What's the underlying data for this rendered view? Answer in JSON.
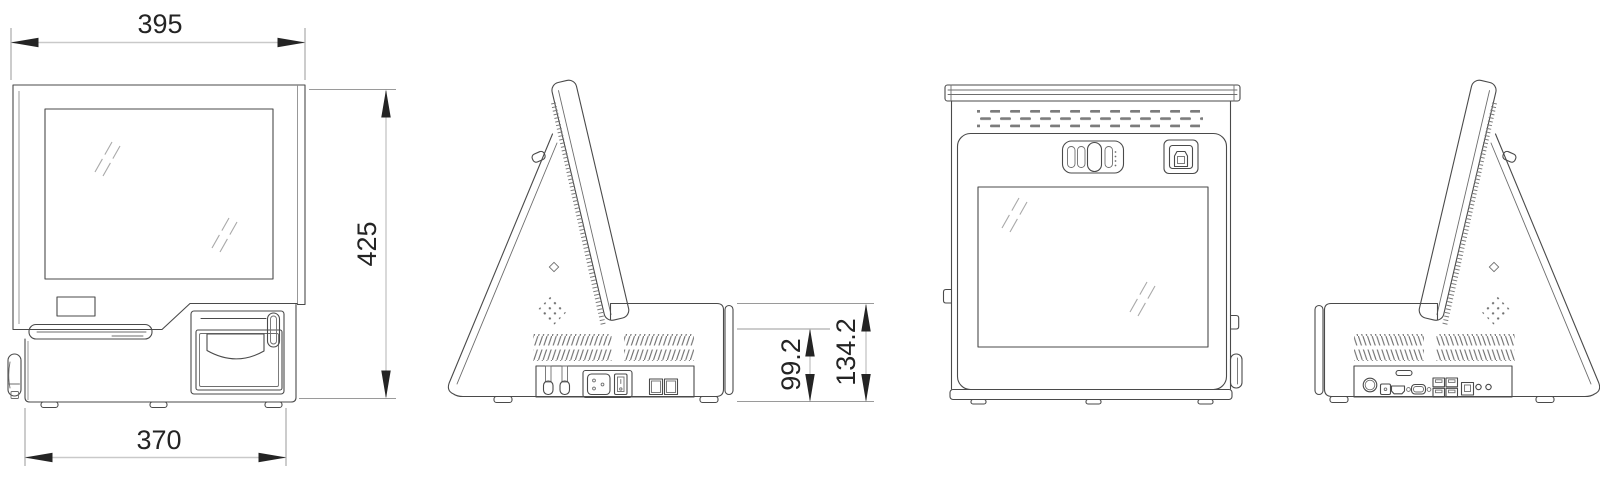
{
  "dimensions": {
    "front_width": "395",
    "overall_height": "425",
    "base_width": "370",
    "rear_base_height": "99.2",
    "base_total_height": "134.2"
  },
  "colors": {
    "background": "#ffffff",
    "outline": "#4a4a4a",
    "detail": "#6e6e6e",
    "dimension_text": "#242424",
    "dimension_line": "#c9c9c9",
    "extension_line": "#9a9a9a",
    "arrow": "#242424"
  }
}
